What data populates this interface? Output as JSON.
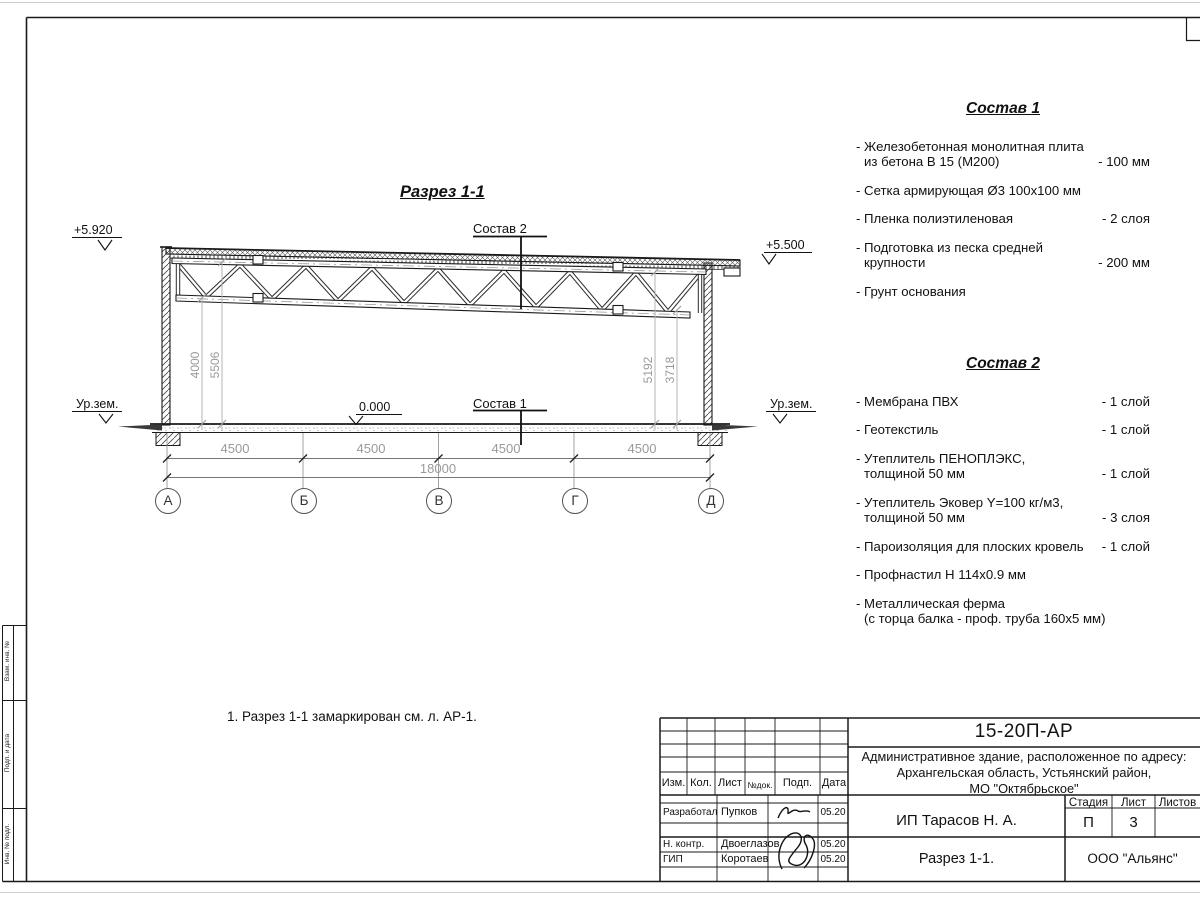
{
  "sheet": {
    "section_title": "Разрез 1-1",
    "note": "1. Разрез 1-1 замаркирован см. л. АР-1.",
    "marks": {
      "elev_top_left": "+5.920",
      "elev_top_right": "+5.500",
      "elev_zero": "0.000",
      "ground_left": "Ур.зем.",
      "ground_right": "Ур.зем.",
      "leader_roof": "Состав 2",
      "leader_floor": "Состав 1"
    },
    "axes": [
      "А",
      "Б",
      "В",
      "Г",
      "Д"
    ],
    "dims": {
      "bays": [
        "4500",
        "4500",
        "4500",
        "4500"
      ],
      "total": "18000",
      "left_vertical": [
        "4000",
        "5506"
      ],
      "right_vertical": [
        "5192",
        "3718"
      ]
    }
  },
  "compositions": [
    {
      "title": "Состав 1",
      "items": [
        {
          "line1": "- Железобетонная  монолитная плита",
          "line2": "из бетона В 15 (М200)",
          "value": "- 100 мм"
        },
        {
          "line1": "- Сетка армирующая Ø3 100х100 мм",
          "line2": "",
          "value": ""
        },
        {
          "line1": "- Пленка полиэтиленовая",
          "line2": "",
          "value": "-  2 слоя"
        },
        {
          "line1": "- Подготовка из песка средней",
          "line2": "крупности",
          "value": "- 200 мм"
        },
        {
          "line1": "- Грунт основания",
          "line2": "",
          "value": ""
        }
      ]
    },
    {
      "title": "Состав 2",
      "items": [
        {
          "line1": "- Мембрана ПВХ",
          "line2": "",
          "value": "- 1 слой"
        },
        {
          "line1": "- Геотекстиль",
          "line2": "",
          "value": "- 1 слой"
        },
        {
          "line1": "- Утеплитель ПЕНОПЛЭКС,",
          "line2": "толщиной 50 мм",
          "value": "- 1 слой"
        },
        {
          "line1": "- Утеплитель Эковер Y=100 кг/м3,",
          "line2": "толщиной 50 мм",
          "value": "- 3 слоя"
        },
        {
          "line1": "- Пароизоляция для плоских кровель",
          "line2": "",
          "value": "- 1 слой"
        },
        {
          "line1": "- Профнастил Н 114х0.9 мм",
          "line2": "",
          "value": ""
        },
        {
          "line1": "- Металлическая ферма",
          "line2": "(с торца балка - проф. труба 160х5 мм)",
          "value": ""
        }
      ]
    }
  ],
  "frame_stamp": {
    "cell_top": "Взам. инв. №",
    "cell_mid": "Подп. и дата",
    "cell_bottom": "Инв. № подл."
  },
  "titleblock": {
    "doc_number": "15-20П-АР",
    "project_lines": [
      "Административное здание, расположенное по адресу:",
      "Архангельская область, Устьянский район,",
      "МО \"Октябрьское\""
    ],
    "client": "ИП Тарасов Н. А.",
    "sheet_name": "Разрез 1-1.",
    "organization": "ООО \"Альянс\"",
    "columns": {
      "izm": "Изм.",
      "kol": "Кол.",
      "list": "Лист",
      "ndoc": "№док.",
      "podp": "Подп.",
      "data": "Дата"
    },
    "stage_label": "Стадия",
    "sheet_label": "Лист",
    "sheets_label": "Листов",
    "stage": "П",
    "sheet_no": "3",
    "sheets_total": "",
    "roles": [
      {
        "role": "Разработал",
        "name": "Пупков",
        "date": "05.20"
      },
      {
        "role": "Н. контр.",
        "name": "Двоеглазов",
        "date": "05.20"
      },
      {
        "role": "ГИП",
        "name": "Коротаев",
        "date": "05.20"
      }
    ]
  }
}
